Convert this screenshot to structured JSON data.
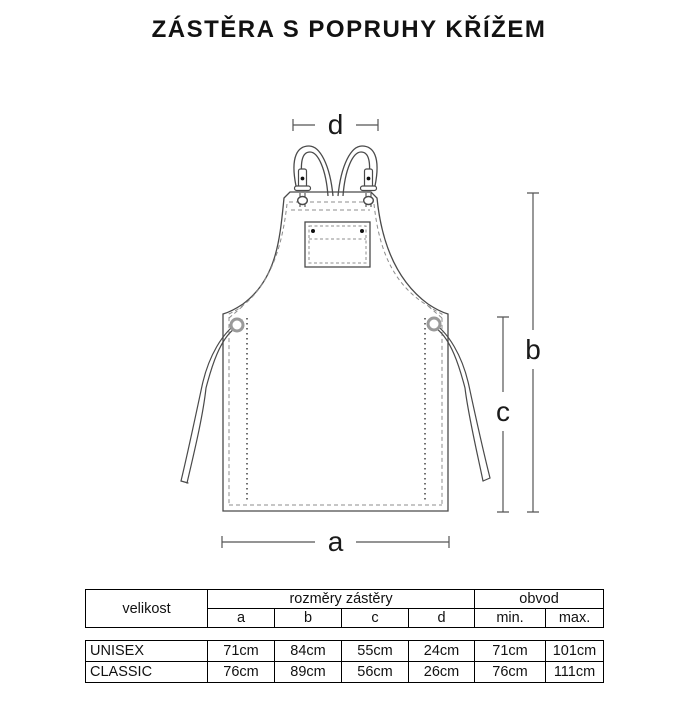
{
  "title": "ZÁSTĚRA S POPRUHY KŘÍŽEM",
  "diagram": {
    "dimension_labels": {
      "a": "a",
      "b": "b",
      "c": "c",
      "d": "d"
    }
  },
  "size_table": {
    "size_column_header": "velikost",
    "dimensions_group_header": "rozměry zástěry",
    "circumference_group_header": "obvod",
    "dimension_columns": [
      "a",
      "b",
      "c",
      "d"
    ],
    "circumference_columns": [
      "min.",
      "max."
    ],
    "rows": [
      {
        "size": "UNISEX",
        "a": "71cm",
        "b": "84cm",
        "c": "55cm",
        "d": "24cm",
        "min": "71cm",
        "max": "101cm"
      },
      {
        "size": "CLASSIC",
        "a": "76cm",
        "b": "89cm",
        "c": "56cm",
        "d": "26cm",
        "min": "76cm",
        "max": "111cm"
      }
    ]
  },
  "colors": {
    "line": "#4a4a4a",
    "stitch": "#8c8c8c",
    "grommet": "#9a9a9a",
    "dimension_line": "#555555",
    "text": "#111111",
    "table_border": "#000000"
  }
}
